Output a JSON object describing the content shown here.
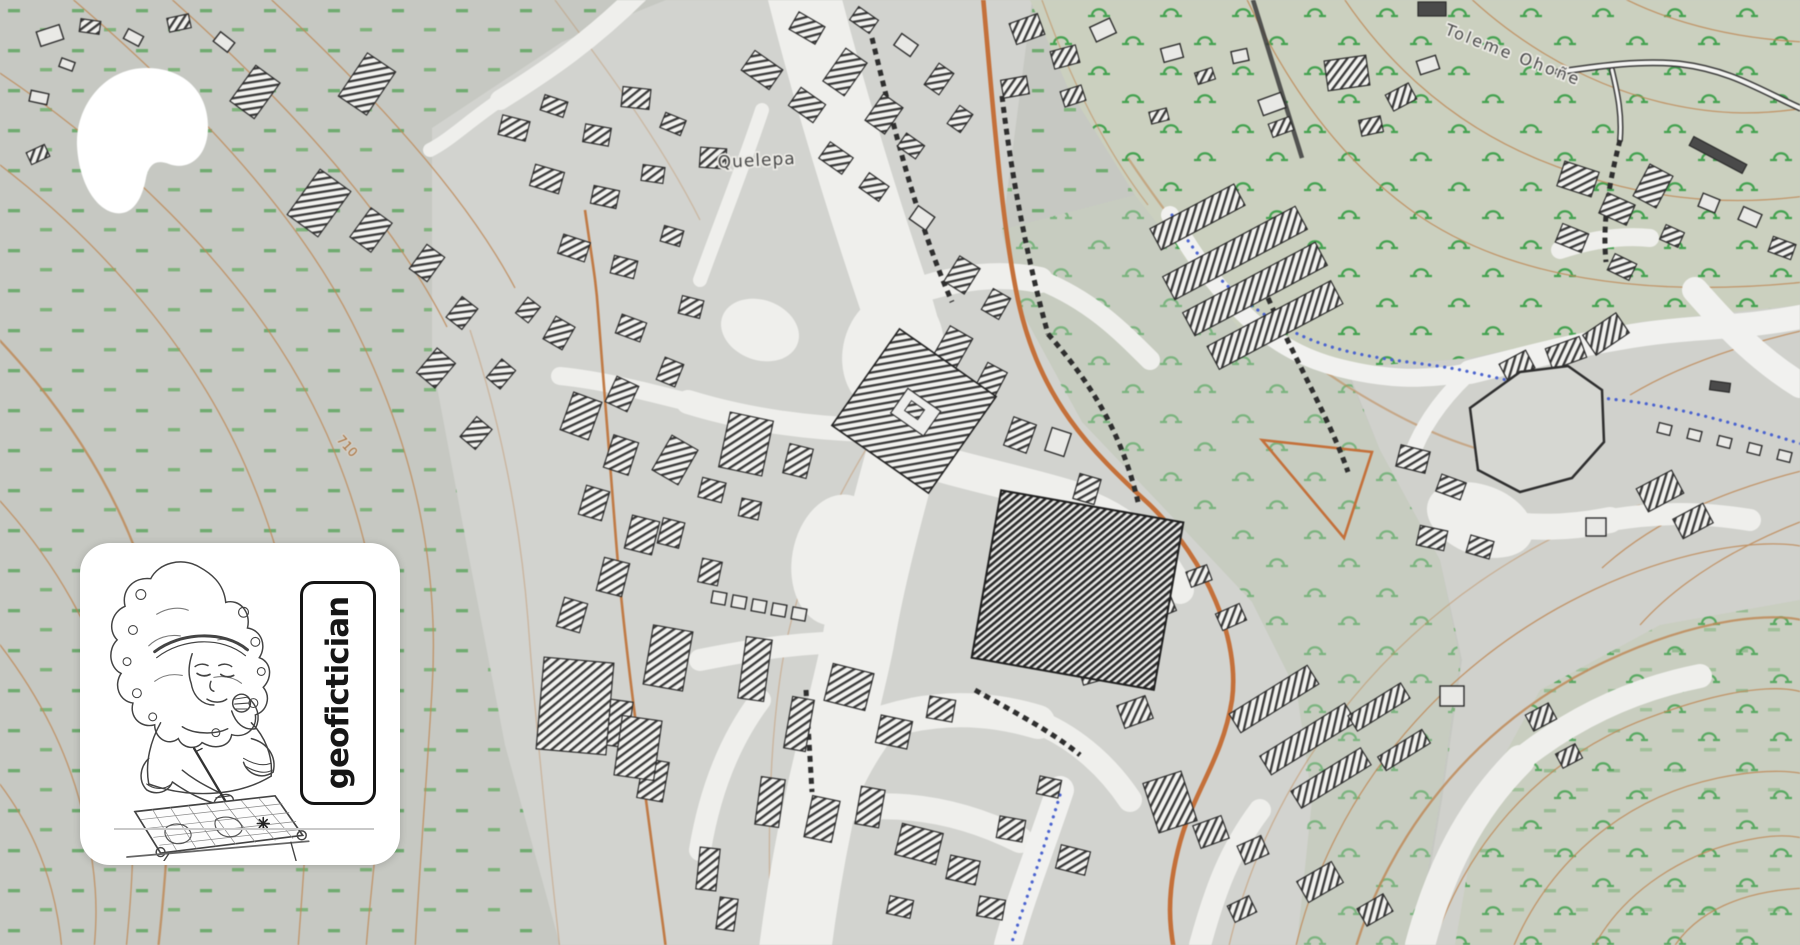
{
  "map": {
    "place_label": "Quelepa",
    "stream_label": "Toleme Ohoñe",
    "contour_label": "710",
    "colors": {
      "background": "#c6c8c2",
      "urban": "#d2d3cf",
      "green_zone": "#cbd0bf",
      "street": "#efefec",
      "contour": "#bf8a58",
      "main_road": "#c4703a",
      "vegetation": "#4ba253",
      "water": "#4a63cf",
      "building_hatch": "#333333"
    }
  },
  "overlays": {
    "patreon_logo_color": "#ffffff",
    "creator_card_text": "geofictician"
  }
}
